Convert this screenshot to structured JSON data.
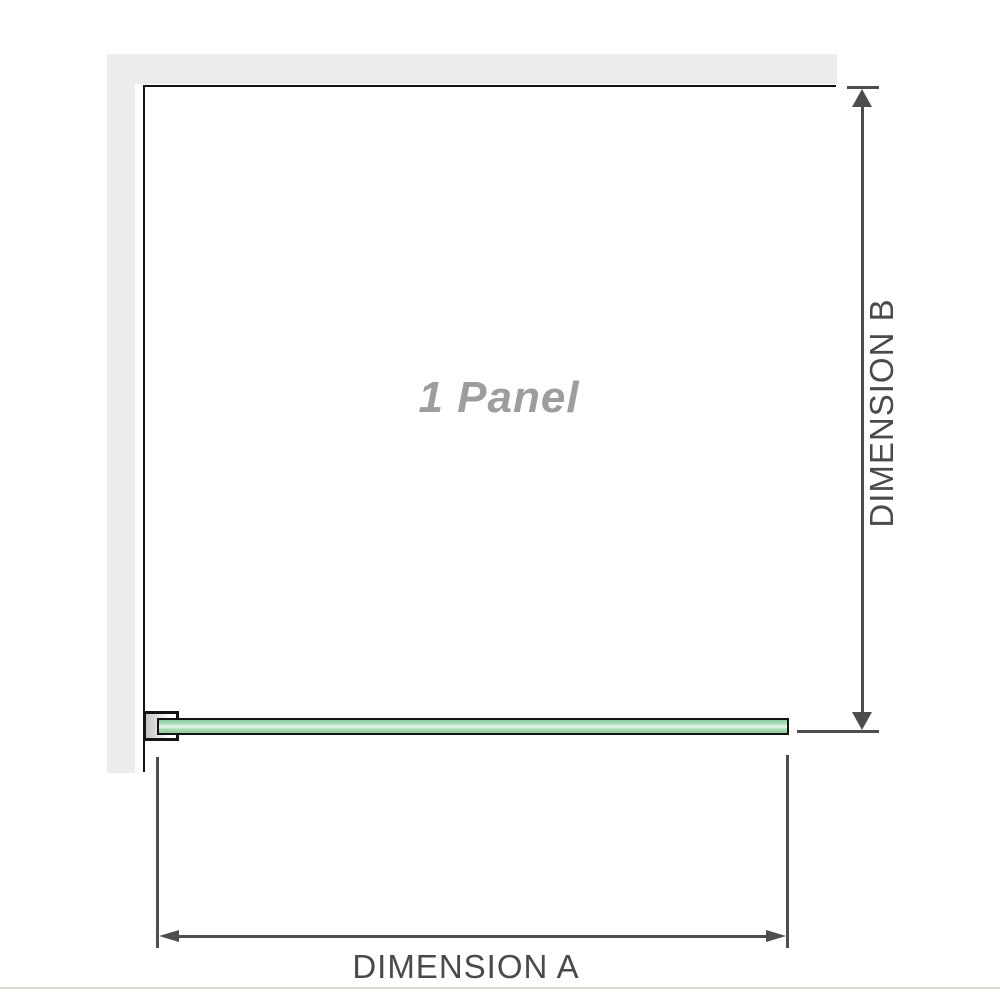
{
  "labels": {
    "panel": "1 Panel",
    "dimension_a": "DIMENSION A",
    "dimension_b": "DIMENSION B"
  },
  "colors": {
    "wall": "#ececec",
    "outline": "#141414",
    "dimension_line": "#4d4d4d",
    "dimension_text": "#4a4a4a",
    "panel_text": "#9d9d9d",
    "glass_green": "#a9dcb7",
    "glass_deep": "#8fcc9f",
    "glass_highlight": "#e9f7ee",
    "bottom_rule": "#dedbd4"
  }
}
